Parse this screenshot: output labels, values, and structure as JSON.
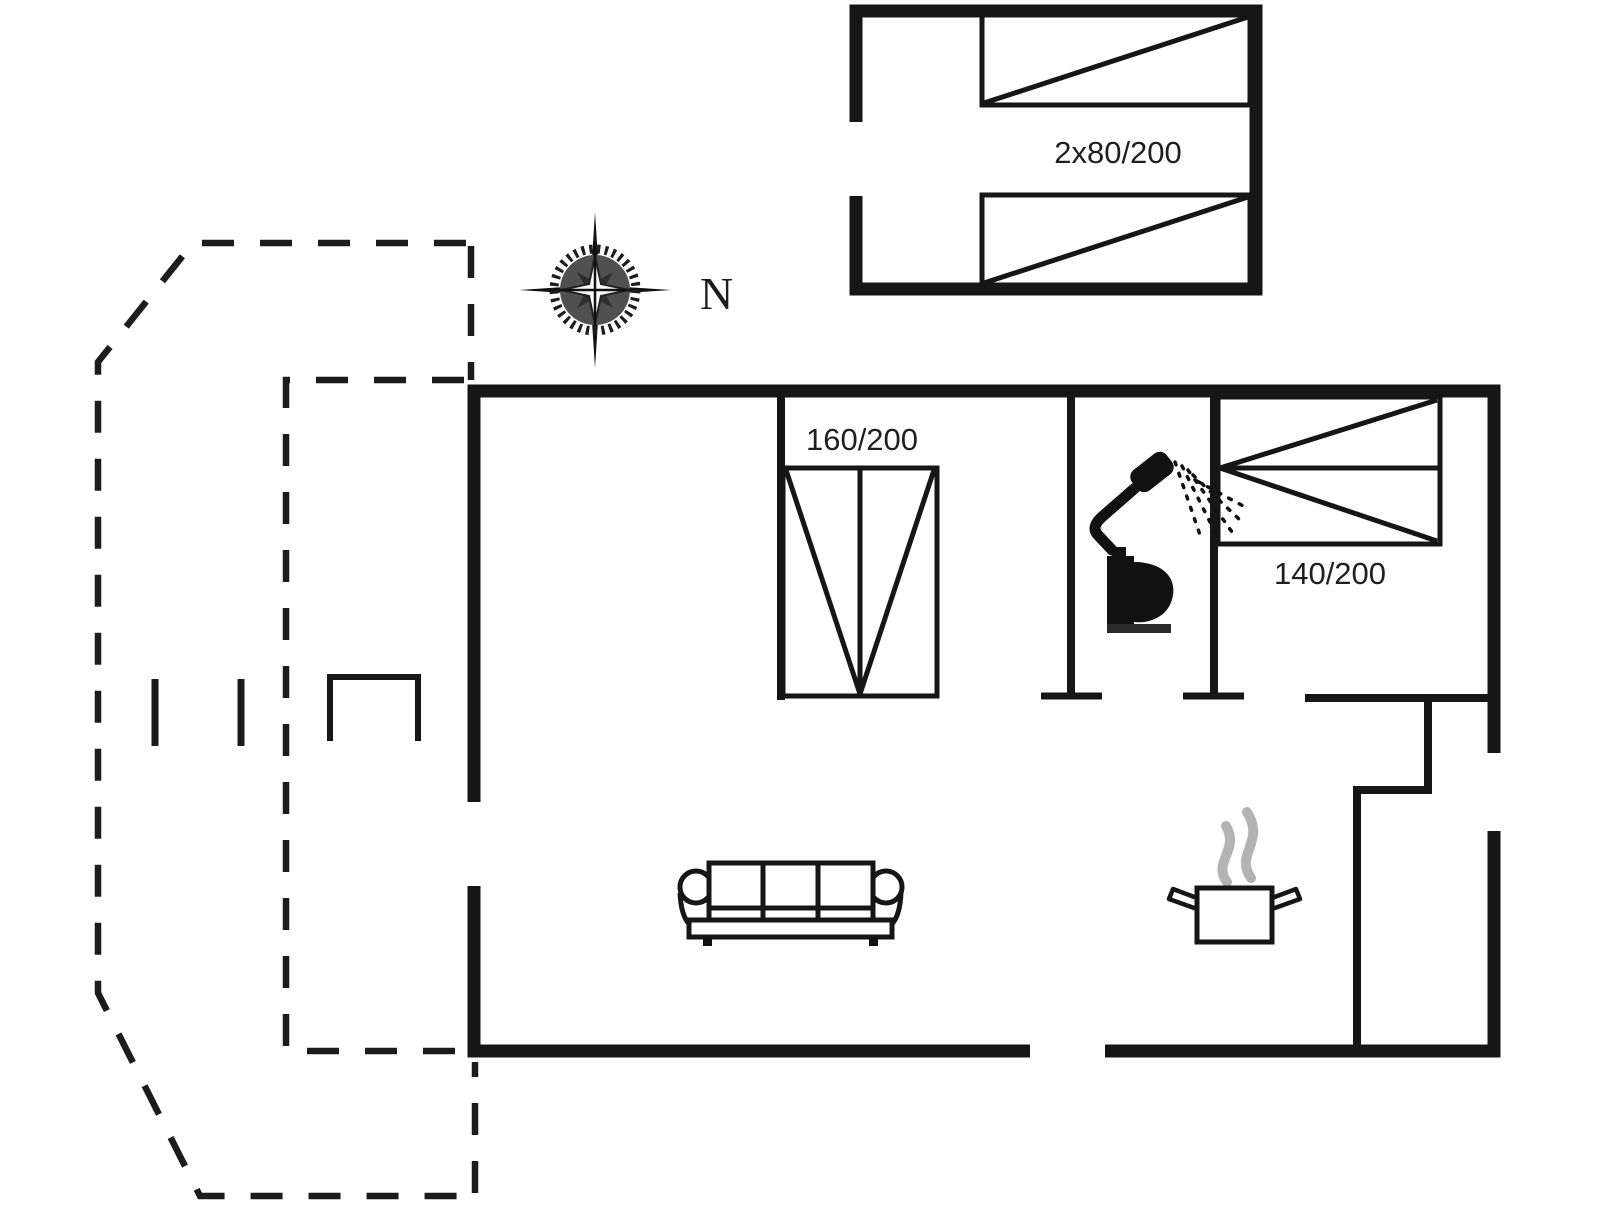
{
  "plan": {
    "type": "floor-plan",
    "labels": {
      "annex_bed": "2x80/200",
      "double_bed": "160/200",
      "small_double_bed": "140/200",
      "compass_north": "N"
    },
    "icons": {
      "compass": "compass-rose-icon",
      "shower": "shower-icon",
      "toilet": "toilet-icon",
      "sofa": "sofa-icon",
      "cooking_pot": "cooking-pot-icon"
    },
    "colors": {
      "line": "#161616",
      "steam": "#b3b3b3",
      "background": "#ffffff"
    }
  }
}
